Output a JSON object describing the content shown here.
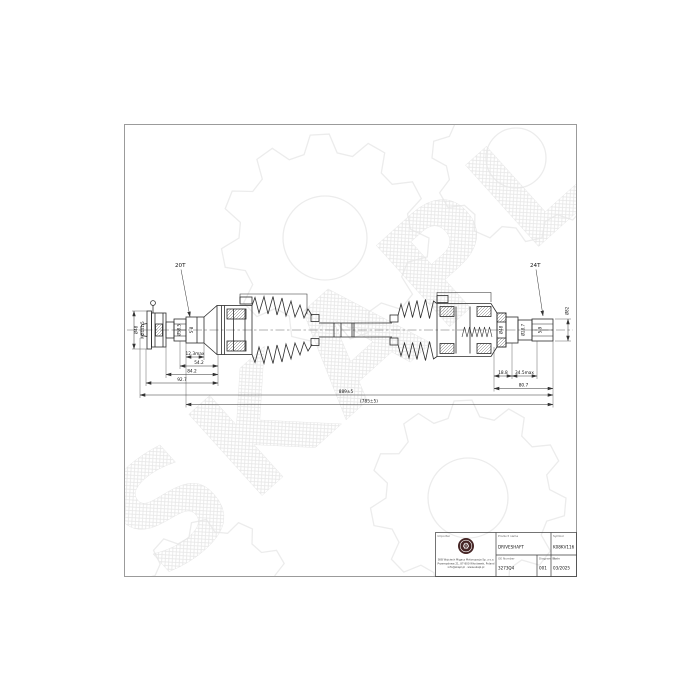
{
  "watermark": {
    "text": "SKAPL"
  },
  "drawing": {
    "left_teeth_label": "20T",
    "right_teeth_label": "24T",
    "left_end": {
      "diameter": "Ø48",
      "thread": "M24x1.5",
      "spline_diameter": "Ø58.5",
      "spline_note": "5-8"
    },
    "right_end": {
      "joint_diameter": "Ø48",
      "seal_diameter": "Ø28.7",
      "spline_note": "5-9",
      "end_diameter": "Ø82"
    },
    "left_dims": [
      "12.3max",
      "54.2",
      "84.2",
      "92.7"
    ],
    "right_dims": [
      "18.8",
      "34.5max",
      "80.7"
    ],
    "overall_length": "889±5",
    "compressed_length": "(785±5)"
  },
  "title_block": {
    "importer_label": "Importer",
    "product_name_label": "Product name",
    "product_name": "DRIVESHAFT",
    "symbol_label": "Symbol",
    "symbol": "K08KV116",
    "oe_number_label": "OE Number",
    "oe_number": "3273Q4",
    "diagram_no_label": "Diagram No",
    "diagram_no": "001",
    "date_label": "Date",
    "date": "03/2025",
    "address_line1": "SKB Wojciech Migacz Motoryzacja Sp. z o.o.",
    "address_line2": "Przemysłowa 21, 87-800 Włocławek, Poland",
    "address_line3": "info@skapl.pl · www.skapl.pl"
  },
  "colors": {
    "line": "#2b2b2b",
    "watermark": "#e8e8e8",
    "logo_badge": "#452525",
    "sheet_border": "#9b9b9b"
  }
}
